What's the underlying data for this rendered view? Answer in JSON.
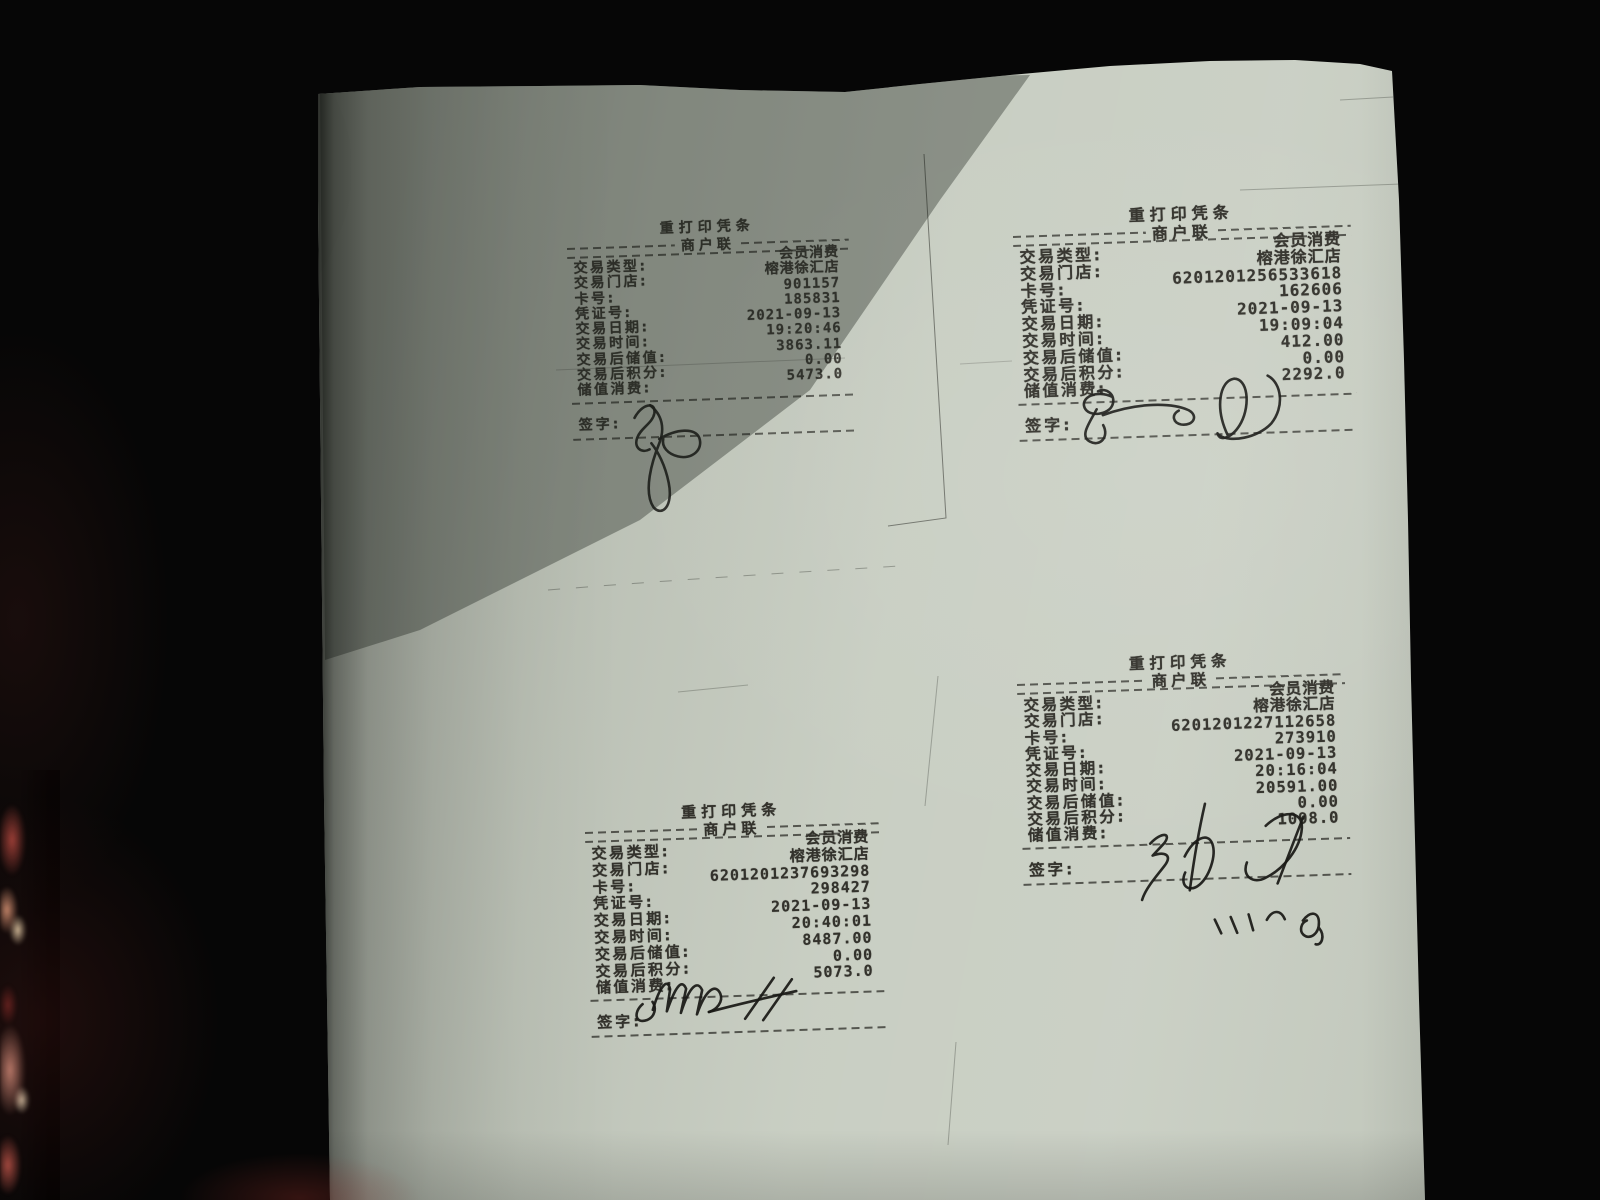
{
  "photo": {
    "description": "Photograph of four reprinted POS receipts printed on one sheet of paper, each with a handwritten signature",
    "background_color": "#060606",
    "paper_color": "#c6ccc0",
    "ink_color": "#33322c",
    "fabric_colors": [
      "#9e4038",
      "#c98d6f",
      "#d9c9a4",
      "#c08473"
    ]
  },
  "receipts": [
    {
      "position": "top-left",
      "title": "重打印凭条",
      "copy_label": "商户联",
      "rows": [
        {
          "label": "交易类型:",
          "value": "会员消费"
        },
        {
          "label": "交易门店:",
          "value": "榕港徐汇店"
        },
        {
          "label": "卡号:",
          "value": "901157"
        },
        {
          "label": "凭证号:",
          "value": "185831"
        },
        {
          "label": "交易日期:",
          "value": "2021-09-13"
        },
        {
          "label": "交易时间:",
          "value": "19:20:46"
        },
        {
          "label": "交易后储值:",
          "value": "3863.11"
        },
        {
          "label": "交易后积分:",
          "value": "0.00"
        },
        {
          "label": "储值消费:",
          "value": "5473.0"
        }
      ],
      "sign_label": "签字:",
      "has_signature": true
    },
    {
      "position": "top-right",
      "title": "重打印凭条",
      "copy_label": "商户联",
      "rows": [
        {
          "label": "交易类型:",
          "value": "会员消费"
        },
        {
          "label": "交易门店:",
          "value": "榕港徐汇店"
        },
        {
          "label": "卡号:",
          "value": "6201201256533618"
        },
        {
          "label": "凭证号:",
          "value": "162606"
        },
        {
          "label": "交易日期:",
          "value": "2021-09-13"
        },
        {
          "label": "交易时间:",
          "value": "19:09:04"
        },
        {
          "label": "交易后储值:",
          "value": "412.00"
        },
        {
          "label": "交易后积分:",
          "value": "0.00"
        },
        {
          "label": "储值消费:",
          "value": "2292.0"
        }
      ],
      "sign_label": "签字:",
      "has_signature": true
    },
    {
      "position": "bottom-left",
      "title": "重打印凭条",
      "copy_label": "商户联",
      "rows": [
        {
          "label": "交易类型:",
          "value": "会员消费"
        },
        {
          "label": "交易门店:",
          "value": "榕港徐汇店"
        },
        {
          "label": "卡号:",
          "value": "6201201237693298"
        },
        {
          "label": "凭证号:",
          "value": "298427"
        },
        {
          "label": "交易日期:",
          "value": "2021-09-13"
        },
        {
          "label": "交易时间:",
          "value": "20:40:01"
        },
        {
          "label": "交易后储值:",
          "value": "8487.00"
        },
        {
          "label": "交易后积分:",
          "value": "0.00"
        },
        {
          "label": "储值消费:",
          "value": "5073.0"
        }
      ],
      "sign_label": "签字:",
      "has_signature": true
    },
    {
      "position": "bottom-right",
      "title": "重打印凭条",
      "copy_label": "商户联",
      "rows": [
        {
          "label": "交易类型:",
          "value": "会员消费"
        },
        {
          "label": "交易门店:",
          "value": "榕港徐汇店"
        },
        {
          "label": "卡号:",
          "value": "6201201227112658"
        },
        {
          "label": "凭证号:",
          "value": "273910"
        },
        {
          "label": "交易日期:",
          "value": "2021-09-13"
        },
        {
          "label": "交易时间:",
          "value": "20:16:04"
        },
        {
          "label": "交易后储值:",
          "value": "20591.00"
        },
        {
          "label": "交易后积分:",
          "value": "0.00"
        },
        {
          "label": "储值消费:",
          "value": "1098.0"
        }
      ],
      "sign_label": "签字:",
      "has_signature": true
    }
  ]
}
